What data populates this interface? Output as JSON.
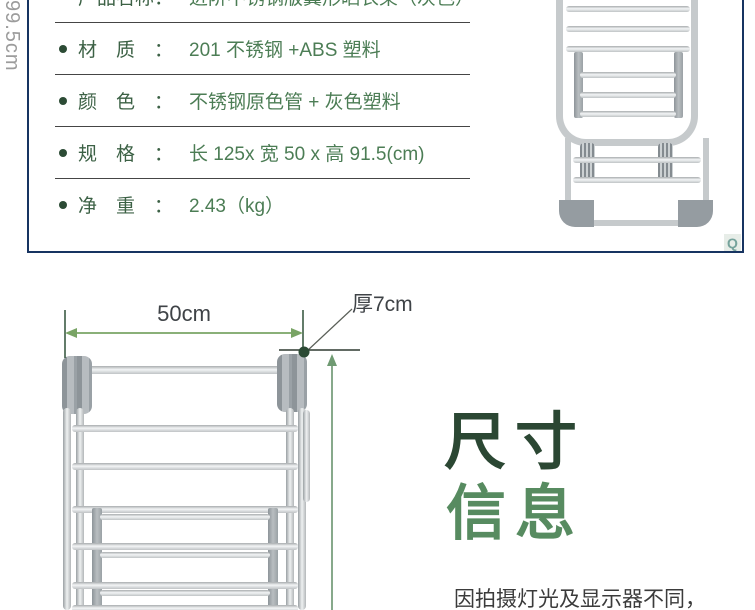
{
  "spec_panel": {
    "rows": [
      {
        "label": "产品名称：",
        "value": "进阶不锈钢版翼形晒衣架（灰色）"
      },
      {
        "label": "材质：",
        "value": "201 不锈钢 +ABS 塑料"
      },
      {
        "label": "颜色：",
        "value": "不锈钢原色管 + 灰色塑料"
      },
      {
        "label": "规格：",
        "value": "长 125x 宽 50 x 高 91.5(cm)"
      },
      {
        "label": "净重：",
        "value": "2.43（kg）"
      }
    ],
    "zoom_glyph": "Q"
  },
  "diagram": {
    "width_label": "50cm",
    "thickness_label": "厚7cm",
    "height_label": "99.5cm"
  },
  "headline": {
    "line1": "尺寸",
    "line2": "信息"
  },
  "caption": "因拍摄灯光及显示器不同，",
  "colors": {
    "panel_border": "#173461",
    "label_green": "#3c6145",
    "value_green": "#4c7d55",
    "headline_dark": "#2b4733",
    "headline_light": "#578b60",
    "dimension_arrow_green": "#79a465",
    "dimension_line_green": "#87a98b",
    "height_text_gray": "#9c9c9c",
    "dot_green": "#2b4a34"
  }
}
